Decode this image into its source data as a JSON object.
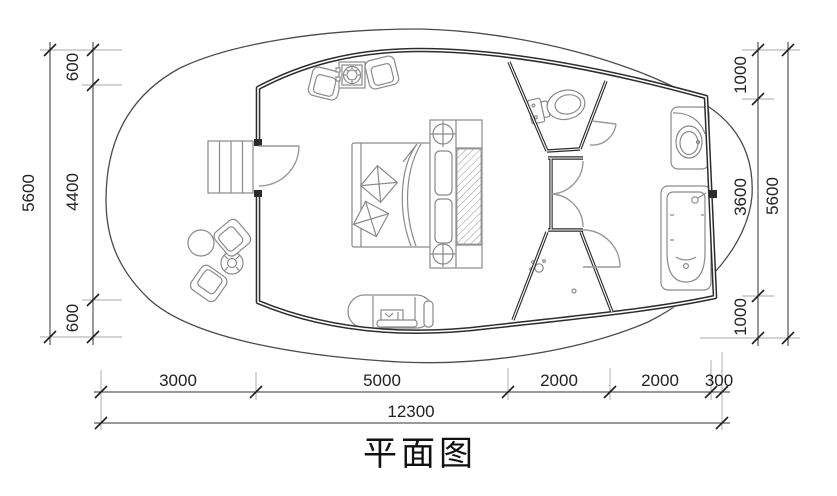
{
  "drawing": {
    "title": "平面图"
  },
  "dimensions": {
    "left": {
      "overall": "5600",
      "segments": [
        "600",
        "4400",
        "600"
      ]
    },
    "right": {
      "overall": "5600",
      "segments": [
        "1000",
        "3600",
        "1000"
      ]
    },
    "bottom": {
      "overall": "12300",
      "segments": [
        "3000",
        "5000",
        "2000",
        "2000",
        "300"
      ]
    }
  },
  "colors": {
    "background": "#ffffff",
    "wall_line": "#2c2c2c",
    "furniture_line": "#8a8a8a",
    "deck_plank_line": "#dfa26d",
    "dimension_line": "#333333"
  },
  "fixtures": [
    "wood-deck",
    "entry-steps",
    "entry-door",
    "lounge-chair",
    "stove-table",
    "double-bed",
    "pillows",
    "headboard-wardrobe",
    "ceiling-lamp",
    "kitchenette-unit",
    "toilet",
    "shower",
    "washbasin",
    "bathtub",
    "deck-chair",
    "deck-round-table",
    "deck-cross-table"
  ]
}
